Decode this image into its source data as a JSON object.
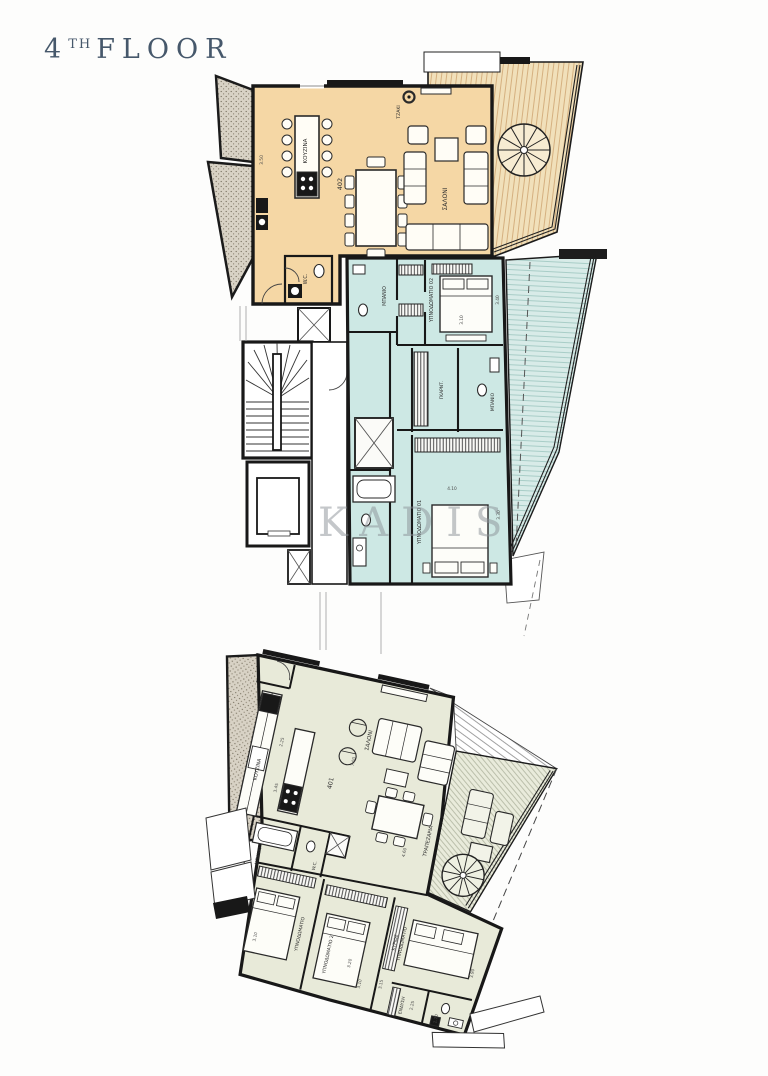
{
  "header": {
    "floor_number": "4",
    "floor_ordinal": "TH",
    "floor_word": "FLOOR"
  },
  "watermark": "KADIS",
  "colors": {
    "title": "#46586b",
    "wall": "#181818",
    "unit402_fill": "#f5d7a5",
    "unit403_fill": "#cde8e4",
    "unit401_fill": "#e8ead9"
  },
  "unit402": {
    "number": "402",
    "kitchen": "ΚΟΥΖΙΝΑ",
    "living": "ΣΑΛΟΝΙ",
    "wc": "W.C.",
    "fireplace": "ΤΖΑΚΙ",
    "dim_side": "3.50"
  },
  "unit403": {
    "bath1": "ΜΠΑΝΙΟ",
    "bedroom02": "ΥΠΝΟΔΩΜΑΤΙΟ 02",
    "closet": "ΓΚΑΡΝΤ.",
    "bath2": "ΜΠΑΝΙΟ",
    "bedroom01": "ΥΠΝΟΔΩΜΑΤΙΟ 01",
    "dim_b02_w": "3.10",
    "dim_b02_h": "3.40",
    "dim_b01_w": "4.10",
    "dim_b01_h": "3.30"
  },
  "unit401": {
    "number": "401",
    "kitchen": "ΚΟΥΖΙΝΑ",
    "living": "ΣΑΛΟΝΙ",
    "dining": "ΤΡΑΠΕΖΑΡΙΑ",
    "bath": "ΜΠΑΝΙΟ",
    "wc": "W.C.",
    "bedroom1": "ΥΠΝΟΔΩΜΑΤΙΟ",
    "bedroom2": "ΥΠΝΟΔΩΜΑΤΙΟ 2",
    "master_line1": "ΚΥΡΙΩΣ",
    "master_line2": "ΥΠΝΟΔΩΜΑΤΙΟ",
    "dressing": "ΕΝΔΥΣΗ",
    "dim_k1": "2.25",
    "dim_k2": "3.45",
    "dim_living": "7.00",
    "dim_dining": "4.60",
    "dim_b1": "3.10",
    "dim_b2a": "3.20",
    "dim_b2b": "3.10",
    "dim_m1": "3.15",
    "dim_m2": "3.90",
    "dim_d1": "2.25",
    "dim_d2": "1.70"
  }
}
